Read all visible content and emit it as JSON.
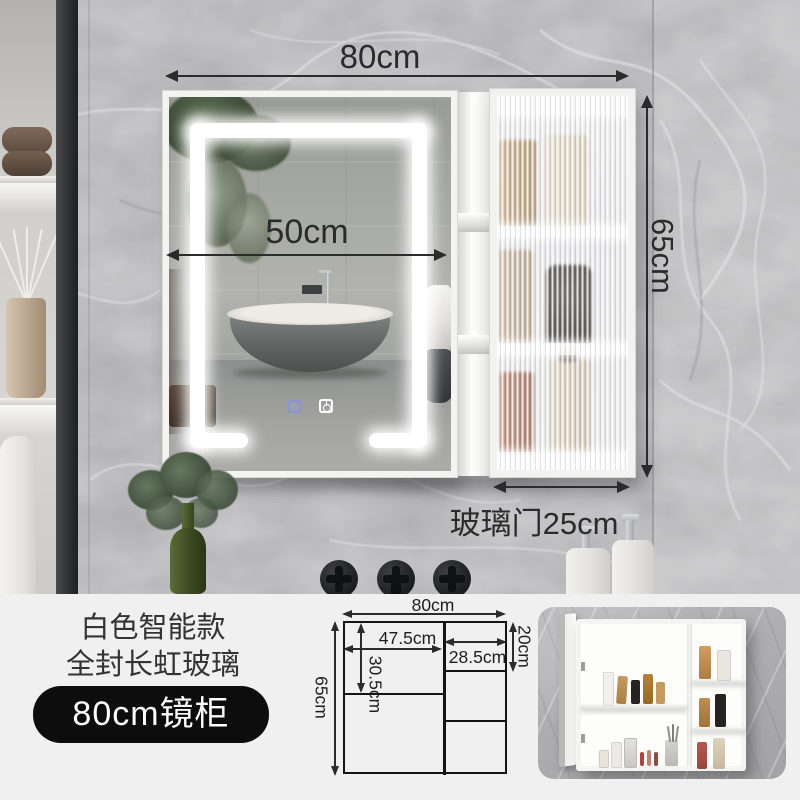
{
  "photo": {
    "dim_total_width": "80cm",
    "dim_mirror_width": "50cm",
    "dim_height": "65cm",
    "dim_glass_door": "玻璃门25cm"
  },
  "info": {
    "line1": "白色智能款",
    "line2": "全封长虹玻璃",
    "badge": "80cm镜柜"
  },
  "drawing": {
    "total_width": "80cm",
    "total_height": "65cm",
    "mirror_width": "47.5cm",
    "mirror_opening_height": "30.5cm",
    "glass_width": "28.5cm",
    "top_shelf_height": "20cm"
  },
  "icons": {
    "power": "power-icon",
    "defog": "defog-icon"
  },
  "colors": {
    "dimension_text": "#2b2b2b",
    "badge_bg": "#0d0d0d",
    "badge_text": "#ffffff",
    "panel_bg": "#f1f0f1",
    "cabinet_frame": "#f3f3f1",
    "marble_wall": "#a9a9ab"
  }
}
